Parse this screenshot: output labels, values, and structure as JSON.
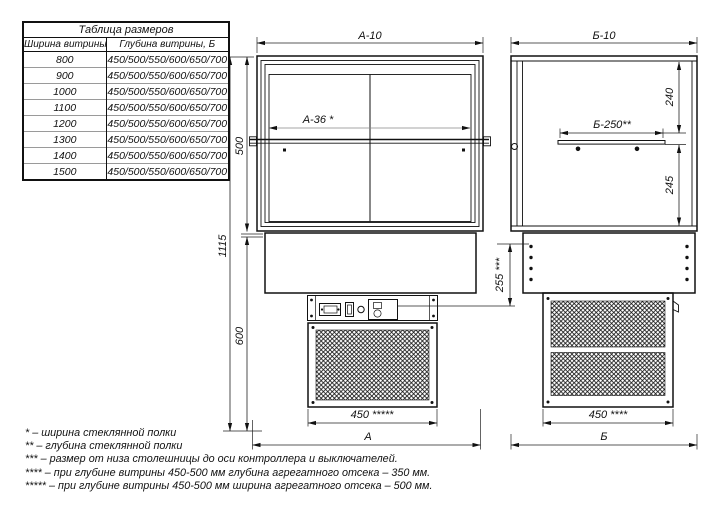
{
  "size_table": {
    "title": "Таблица размеров",
    "col_width": "Ширина витрины, А",
    "col_depth": "Глубина витрины, Б",
    "rows": [
      {
        "width": "800",
        "depths": "450/500/550/600/650/700"
      },
      {
        "width": "900",
        "depths": "450/500/550/600/650/700"
      },
      {
        "width": "1000",
        "depths": "450/500/550/600/650/700"
      },
      {
        "width": "1100",
        "depths": "450/500/550/600/650/700"
      },
      {
        "width": "1200",
        "depths": "450/500/550/600/650/700"
      },
      {
        "width": "1300",
        "depths": "450/500/550/600/650/700"
      },
      {
        "width": "1400",
        "depths": "450/500/550/600/650/700"
      },
      {
        "width": "1500",
        "depths": "450/500/550/600/650/700"
      }
    ]
  },
  "dims": {
    "a10": "А-10",
    "a36": "А-36 *",
    "h500": "500",
    "h1115": "1115",
    "h600": "600",
    "d255": "255 ***",
    "w450_front": "450 *****",
    "a": "А",
    "b10": "Б-10",
    "b250": "Б-250**",
    "h240": "240",
    "h245": "245",
    "w450_side": "450 ****",
    "b": "Б"
  },
  "footnotes": [
    "* – ширина стеклянной полки",
    "** – глубина стеклянной полки",
    "*** – размер от низа столешницы до оси контроллера и выключателей.",
    "**** – при глубине витрины 450-500 мм глубина агрегатного отсека – 350 мм.",
    "***** – при глубине витрины 450-500 мм ширина агрегатного отсека – 500 мм."
  ],
  "colors": {
    "line": "#111111",
    "background": "#ffffff",
    "light_line": "#888888"
  }
}
